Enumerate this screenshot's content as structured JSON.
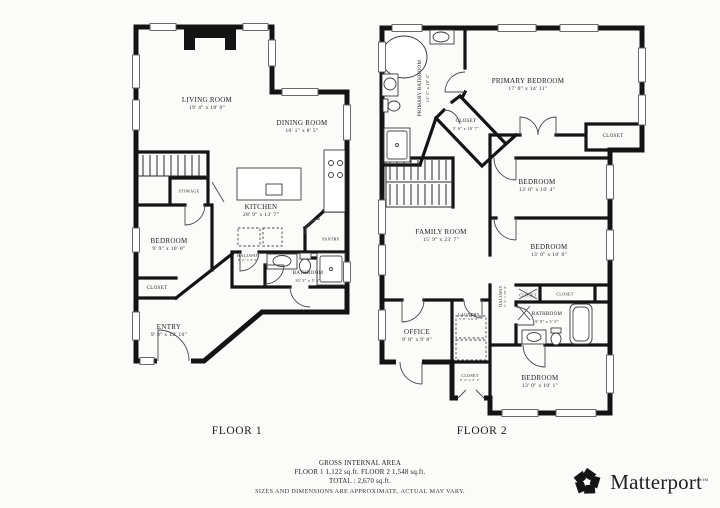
{
  "floor1": {
    "label": "FLOOR 1",
    "rooms": {
      "living": {
        "name": "LIVING ROOM",
        "dims": "19' 4\" x 18' 0\""
      },
      "dining": {
        "name": "DINING ROOM",
        "dims": "10' 1\" x 8' 5\""
      },
      "kitchen": {
        "name": "KITCHEN",
        "dims": "28' 9\" x 13' 7\""
      },
      "bedroom": {
        "name": "BEDROOM",
        "dims": "9' 9\" x 10' 0\""
      },
      "entry": {
        "name": "ENTRY",
        "dims": "9' 8\" x 12' 10\""
      },
      "bathroom": {
        "name": "BATHROOM",
        "dims": "10' 5\" x 5' 2\""
      },
      "hallway": {
        "name": "HALLWAY",
        "dims": "6' 2\" x 3' 4\""
      },
      "storage": {
        "name": "STORAGE"
      },
      "pantry": {
        "name": "PANTRY"
      },
      "closet": {
        "name": "CLOSET"
      }
    }
  },
  "floor2": {
    "label": "FLOOR 2",
    "rooms": {
      "primary_bedroom": {
        "name": "PRIMARY BEDROOM",
        "dims": "17' 0\" x 14' 11\""
      },
      "primary_bathroom": {
        "name": "PRIMARY BATHROOM",
        "dims": "11' 5\" x 10' 4\""
      },
      "walk_closet": {
        "name": "CLOSET",
        "dims": "5' 6\" x 10' 7\""
      },
      "closet_right": {
        "name": "CLOSET"
      },
      "bedroom1": {
        "name": "BEDROOM",
        "dims": "13' 0\" x 10' 4\""
      },
      "bedroom2": {
        "name": "BEDROOM",
        "dims": "13' 0\" x 10' 0\""
      },
      "family": {
        "name": "FAMILY ROOM",
        "dims": "15' 9\" x 23' 7\""
      },
      "hallway": {
        "name": "HALLWAY",
        "dims": "2' 4\" x 10' 9\""
      },
      "closet_small": {
        "name": "CLOSET"
      },
      "closet_bath": {
        "name": "CLOSET"
      },
      "bathroom": {
        "name": "BATHROOM",
        "dims": "9' 9\" x 5' 9\""
      },
      "office": {
        "name": "OFFICE",
        "dims": "9' 8\" x 9' 8\""
      },
      "laundry": {
        "name": "LAUNDRY",
        "dims": "5' 8\" x 6' 8\""
      },
      "closet_bottom": {
        "name": "CLOSET",
        "dims": "6' 2\" x 5' 1\""
      },
      "bedroom3": {
        "name": "BEDROOM",
        "dims": "13' 0\" x 10' 1\""
      }
    }
  },
  "footer": {
    "line1": "GROSS INTERNAL AREA",
    "line2": "FLOOR 1 1,122 sq.ft. FLOOR 2 1,548 sq.ft.",
    "line3": "TOTAL : 2,670 sq.ft.",
    "line4": "SIZES AND DIMENSIONS ARE APPROXIMATE, ACTUAL MAY VARY."
  },
  "brand": {
    "name": "Matterport",
    "mark": "™"
  }
}
